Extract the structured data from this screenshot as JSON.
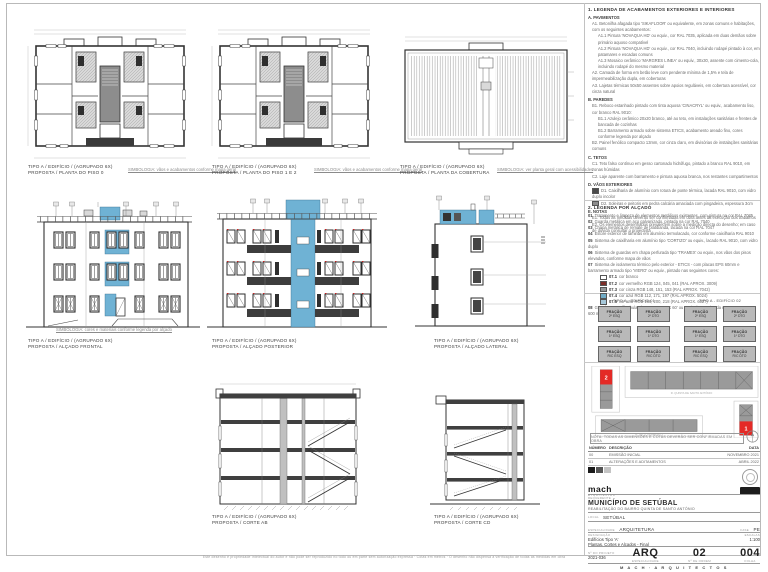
{
  "page": {
    "bottom_note": "Este desenho é propriedade intelectual do autor e não pode ser reproduzido no todo ou em parte sem autorização expressa · Cotas em metros · O desenho não dispensa a verificação de todas as medidas em obra"
  },
  "drawings": {
    "plan0": {
      "l1": "TIPO A / EDIFÍCIO / (AGRUPADO 6X)",
      "l2": "PROPOSTA / PLANTA DO PISO 0",
      "note": "SIMBOLOGIA: vãos e acabamentos conforme mapa geral"
    },
    "plan12": {
      "l1": "TIPO A / EDIFÍCIO / (AGRUPADO 6X)",
      "l2": "PROPOSTA / PLANTA DO PISO 1 E 2",
      "note": "SIMBOLOGIA: vãos e acabamentos conforme mapa geral"
    },
    "roof": {
      "l1": "TIPO A / EDIFÍCIO / (AGRUPADO 6X)",
      "l2": "PROPOSTA / PLANTA DA COBERTURA",
      "note": "SIMBOLOGIA: ver planta geral com acessibilidades"
    },
    "front": {
      "l1": "TIPO A / EDIFÍCIO / (AGRUPADO 6X)",
      "l2": "PROPOSTA / ALÇADO FRONTAL",
      "note": "SIMBOLOGIA: cores e materiais conforme legenda por alçado"
    },
    "rear": {
      "l1": "TIPO A / EDIFÍCIO / (AGRUPADO 6X)",
      "l2": "PROPOSTA / ALÇADO POSTERIOR"
    },
    "side": {
      "l1": "TIPO A / EDIFÍCIO / (AGRUPADO 6X)",
      "l2": "PROPOSTA / ALÇADO LATERAL"
    },
    "sectAB": {
      "l1": "TIPO A / EDIFÍCIO / (AGRUPADO 6X)",
      "l2": "PROPOSTA / CORTE AB"
    },
    "sectCD": {
      "l1": "TIPO A / EDIFÍCIO / (AGRUPADO 6X)",
      "l2": "PROPOSTA / CORTE CD"
    }
  },
  "legend_finishes": {
    "title": "1. LEGENDA DE ACABAMENTOS EXTERIORES E INTERIORES",
    "lines": [
      {
        "s": "h",
        "t": "A. PAVIMENTOS"
      },
      {
        "s": "i",
        "t": "A1. Betonilha afagada tipo 'SIKAFLOOR' ou equivalente, em zonas comuns e habitações, com os seguintes acabamentos:"
      },
      {
        "s": "s",
        "t": "A1.1 Pintura 'NOVAQUA HD' ou equiv., cor RAL 7035, aplicada em duas demãos sobre primário aquoso compatível"
      },
      {
        "s": "s",
        "t": "A1.2 Pintura 'NOVAQUA HD' ou equiv., cor RAL 7040, incluindo rodapé pintado à cor, em patamares e escadas comuns"
      },
      {
        "s": "s",
        "t": "A1.3 Mosaico cerâmico 'MARGRES LINEA' ou equiv., 30x30, assente com cimento-cola, incluindo rodapé do mesmo material"
      },
      {
        "s": "i",
        "t": "A2. Camada de forma em betão leve com pendente mínima de 1,5% e tela de impermeabilização dupla, em coberturas"
      },
      {
        "s": "i",
        "t": "A3. Lajetas térmicas 50x50 assentes sobre apoios reguláveis, em cobertura acessível, cor cinza natural"
      },
      {
        "s": "h",
        "t": "B. PAREDES"
      },
      {
        "s": "i",
        "t": "B1. Reboco estanhado pintado com tinta aquosa 'CINACRYL' ou equiv., acabamento liso, cor branco RAL 9010:"
      },
      {
        "s": "s",
        "t": "B1.1 Azulejo cerâmico 20x20 branco, até ao teto, em instalações sanitárias e frentes de bancada de cozinhas"
      },
      {
        "s": "s",
        "t": "B1.2 Barramento armado sobre sistema ETICS, acabamento areado fino, cores conforme legenda por alçado"
      },
      {
        "s": "i",
        "t": "B2. Painel fenólico compacto 13mm, cor cinza claro, em divisórias de instalações sanitárias comuns"
      },
      {
        "s": "h",
        "t": "C. TETOS"
      },
      {
        "s": "i",
        "t": "C1. Teto falso contínuo em gesso cartonado hidrófugo, pintado a branco RAL 9010, em zonas húmidas"
      },
      {
        "s": "i",
        "t": "C2. Laje aparente com barramento e pintura aquosa branca, nos restantes compartimentos"
      },
      {
        "s": "h",
        "t": "D. VÃOS EXTERIORES"
      },
      {
        "s": "i",
        "sw": "#4a4a4a",
        "t": "D1. Caixilharia de alumínio com rotura de ponte térmica, lacada RAL 9010, com vidro duplo incolor"
      },
      {
        "s": "i",
        "sw": "#8d8d8d",
        "t": "D2. Soleiras e peitoris em pedra calcária amaciada com pingadeira, espessura 3cm"
      },
      {
        "s": "h",
        "t": "E. NOTAS"
      },
      {
        "s": "i",
        "t": "E1. Todas as medidas deverão ser confirmadas em obra antes da execução dos trabalhos"
      },
      {
        "s": "i",
        "t": "E2. Os elementos desenhados prevalecem sobre a medição directa do desenho; em caso de dúvida consultar o projectista"
      }
    ]
  },
  "legend_elev": {
    "title": "2. LEGENDA POR ALÇADO",
    "lines": [
      {
        "n": "01",
        "t": "Tratamento e limpeza de elementos metálicos existentes, com pintura na cor RAL 7035"
      },
      {
        "n": "02",
        "t": "Guarda metálica em aço galvanizado, pintada na cor RAL 7040"
      },
      {
        "n": "03",
        "t": "Chapa metálica de remate de platibanda, lacada na cor RAL 7047"
      },
      {
        "n": "04",
        "t": "Estore exterior de lâminas em alumínio termolacado, cor conforme caixilharia RAL 9010"
      },
      {
        "n": "05",
        "t": "Sistema de caixilharia em alumínio tipo 'CORTIZO' ou equiv., lacado RAL 9010, com vidro duplo"
      },
      {
        "n": "06",
        "t": "Sistema de guardas em chapa perfurada tipo 'TRAMEX' ou equiv., nos vãos dos pisos elevados, conforme mapa de vãos"
      },
      {
        "n": "07",
        "t": "Sistema de isolamento térmico pelo exterior - ETICS - com placas EPS 60mm e barramento armado tipo 'VIERO' ou equiv., pintado nas seguintes cores:"
      },
      {
        "n": "07.1",
        "sub": true,
        "sw": "#ffffff",
        "t": "cor branco"
      },
      {
        "n": "07.2",
        "sub": true,
        "sw": "#7c2d29",
        "t": "cor vermelho RGB 124, 045, 041 (RAL APROX. 3009)"
      },
      {
        "n": "07.3",
        "sub": true,
        "sw": "#949799",
        "t": "cor cinza RGB 148, 151, 153 (RAL APROX. 7042)"
      },
      {
        "n": "07.4",
        "sub": true,
        "sw": "#70abc5",
        "t": "cor azul RGB 112, 171, 197 (RAL APROX. 5024)"
      },
      {
        "n": "07.5",
        "sub": true,
        "sw": "#a6c8da",
        "t": "cor azul RGB 166, 200, 218 (RAL APROX. 6027)"
      },
      {
        "n": "08",
        "t": "Guarda em perfil tubular de aço 'TRAMEX 60' ou equivalente, pintada na RAL 9010, com 600 mm de altura"
      }
    ]
  },
  "fractions": {
    "cell_label": "FRAÇÃO",
    "groups": [
      {
        "title": "TIPO A - EDIFÍCIO 01",
        "cells": [
          "2º ESQ",
          "2º DTO",
          "1º ESQ",
          "1º DTO",
          "R/C ESQ",
          "R/C DTO"
        ]
      },
      {
        "title": "TIPO A - EDIFÍCIO 02",
        "cells": [
          "2º ESQ",
          "2º DTO",
          "1º ESQ",
          "1º DTO",
          "R/C ESQ",
          "R/C DTO"
        ]
      }
    ]
  },
  "key_plan": {
    "block_a": "2",
    "block_b": "1",
    "street_top": "R. QUINTA DE SANTO ANTÓNIO",
    "street_bottom": "R. DO LOTEAMENTO"
  },
  "note_strip": {
    "text": "NOTA: TODAS AS DIMENSÕES E COTAS DEVERÃO SER CONFIRMADAS EM OBRA"
  },
  "revisions": {
    "headers": [
      "NÚMERO",
      "DESCRIÇÃO",
      "DATA"
    ],
    "rows": [
      [
        "00",
        "EMISSÃO INICIAL",
        "NOVEMBRO 2021"
      ],
      [
        "01",
        "ALTERAÇÕES E ADITAMENTOS",
        "ABRIL 2022"
      ]
    ]
  },
  "title_block": {
    "logo_text": "mach",
    "logo_sub": "arquitectos",
    "client_label": "REQUERENTE",
    "client": "MUNICÍPIO DE SETÚBAL",
    "client_sub": "REABILITAÇÃO DO BAIRRO QUINTA DE SANTO ANTÓNIO",
    "local_label": "LOCAL",
    "local": "SETÚBAL",
    "spec_label": "ESPECIALIDADE",
    "spec": "ARQUITETURA",
    "fase_label": "FASE",
    "fase": "PE",
    "desig_label": "DESIGNAÇÃO",
    "desig1": "Edifícios Tipo 'A'",
    "desig2": "Plantas, Cortes e Alçados - Final",
    "escala_label": "ESCALAS",
    "escala": "1:100",
    "proj_label": "Nº DO PROJETO",
    "proj": "2021-036",
    "rev_label": "REVISÃO",
    "rev": "01",
    "code": "ARQ",
    "code_label": "ESPECIALIDADE",
    "num": "02",
    "num_label": "Nº DE ORDEM",
    "sheet": "004",
    "sheet_label": "FOLHA",
    "spaced": "M A C H · A R Q U I T E C T O S"
  }
}
